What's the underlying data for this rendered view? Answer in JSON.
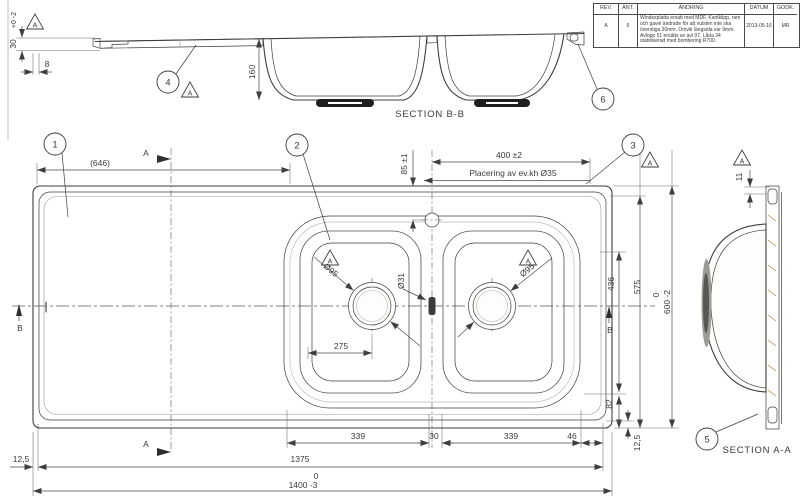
{
  "drawing": {
    "revision_table": {
      "headers": {
        "rev": "REV.",
        "ant": "ANT.",
        "andring": "ÄNDRING",
        "datum": "DATUM",
        "godk": "GODK."
      },
      "row": {
        "rev": "A",
        "ant": "6",
        "andring_lines": [
          "Windexplatta ersatt med MDF. Kantklipp, ram",
          "och gavel ändrade för att vulsten inte ska",
          "överstiga 30mm. Omvik längsida var 9mm.",
          "Avlopp 51 ersätts av avl 97. Låda 34",
          "stabiliserad med bombering R700."
        ],
        "datum": "2013-05-16",
        "godk": "MR"
      }
    },
    "section_bb": {
      "label": "SECTION B-B",
      "dim_160": "160",
      "dim_30": "30",
      "dim_30_tol": "+0 -2",
      "dim_8": "8"
    },
    "section_aa": {
      "label": "SECTION A-A",
      "dim_11": "11"
    },
    "plan": {
      "dim_646": "(646)",
      "dim_400": "400 ±2",
      "dim_85": "85 ±1",
      "faucet_note": "Placering av ev.kh  Ø35",
      "dim_d95_left": "Ø95",
      "dim_d95_right": "Ø95",
      "dim_d31": "Ø31",
      "dim_275": "275",
      "dim_436": "436",
      "dim_575": "575",
      "dim_600_upper": "0",
      "dim_600": "600 -2",
      "dim_82": "82",
      "dim_125_right": "12,5",
      "dim_125_left": "12,5",
      "dim_339_left": "339",
      "dim_30_mid": "30",
      "dim_339_right": "339",
      "dim_46": "46",
      "dim_1375": "1375",
      "dim_1400_upper": "0",
      "dim_1400": "1400 -3"
    },
    "cut_labels": {
      "a": "A",
      "b": "B"
    },
    "flag_label": "A",
    "balloons": {
      "b1": "1",
      "b2": "2",
      "b3": "3",
      "b4": "4",
      "b5": "5",
      "b6": "6"
    },
    "colors": {
      "wood": "#e2a45f",
      "wood_grain": "#a9752f",
      "rim_gray": "#d7d4cc",
      "line": "#3f3e3c"
    }
  }
}
